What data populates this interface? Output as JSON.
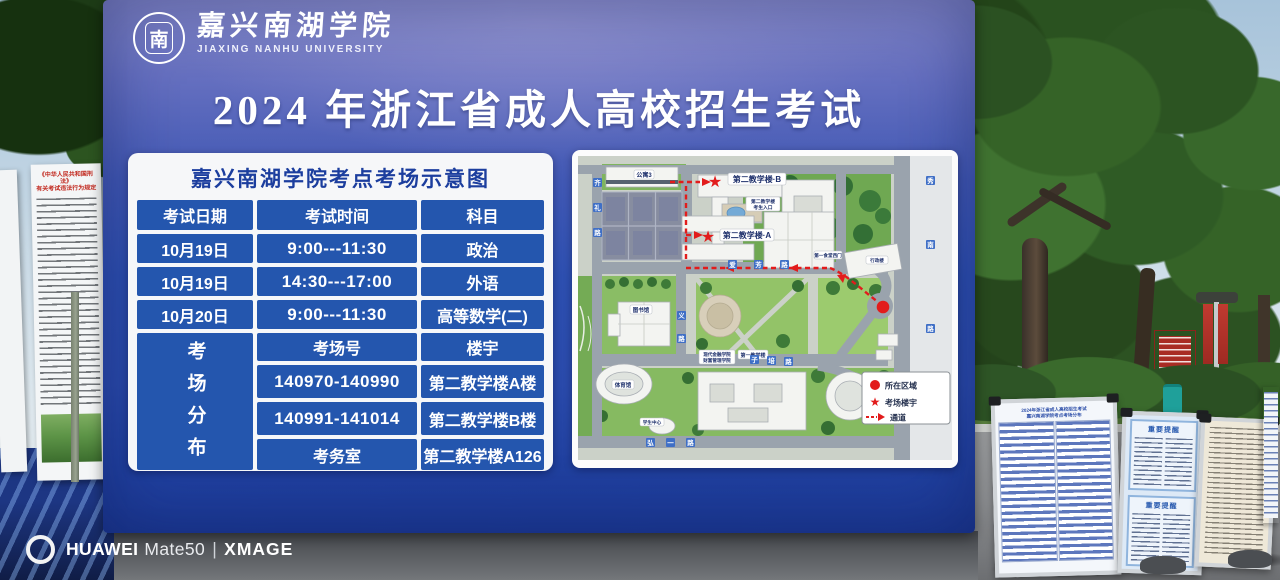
{
  "colors": {
    "billboard_blue": "#2d4fb0",
    "billboard_purple_top": "#8387c9",
    "table_cell_blue": "#2456ae",
    "accent_red": "#dd1f1f",
    "road_tile_blue": "#3f6fc6"
  },
  "billboard": {
    "university": {
      "seal_char": "南",
      "name_cn": "嘉兴南湖学院",
      "name_en": "JIAXING NANHU UNIVERSITY"
    },
    "title": "2024 年浙江省成人高校招生考试",
    "schedule": {
      "panel_title": "嘉兴南湖学院考点考场示意图",
      "headers": [
        "考试日期",
        "考试时间",
        "科目"
      ],
      "rows": [
        [
          "10月19日",
          "9:00---11:30",
          "政治"
        ],
        [
          "10月19日",
          "14:30---17:00",
          "外语"
        ],
        [
          "10月20日",
          "9:00---11:30",
          "高等数学(二)"
        ]
      ],
      "distribution_label": "考场分布",
      "venue_headers": [
        "考场号",
        "楼宇"
      ],
      "venue_rows": [
        [
          "140970-140990",
          "第二教学楼A楼"
        ],
        [
          "140991-141014",
          "第二教学楼B楼"
        ],
        [
          "考务室",
          "第二教学楼A126"
        ]
      ]
    },
    "map": {
      "buildings": {
        "apartment3": "公寓3",
        "teaching_b": "第二教学楼·B",
        "teaching_a": "第二教学楼·A",
        "entrance_line1": "第二教学楼",
        "entrance_line2": "考生入口",
        "canteen_west_gate": "第一食堂西门",
        "finance_line1": "现代金融学院",
        "finance_line2": "财富管理学院",
        "first_teaching": "第一教学楼",
        "library": "图书馆",
        "gym": "体育馆",
        "student_center": "学生中心",
        "admin": "行政楼"
      },
      "roads": {
        "qili": "齐礼路",
        "aifang": "爱芳路",
        "yilu": "义路",
        "zipei": "子培路",
        "hongyi": "弘一路",
        "xiunan": "秀南路"
      },
      "legend": [
        {
          "icon": "location-dot",
          "label": "所在区域"
        },
        {
          "icon": "exam-star",
          "label": "考场楼宇"
        },
        {
          "icon": "route-arrow",
          "label": "通道"
        }
      ]
    }
  },
  "left_posters": {
    "law_title_1": "《中华人民共和国刑法》",
    "law_title_2": "有关考试违法行为规定"
  },
  "right_posters": {
    "seat_title_1": "2024年浙江省成人高校招生考试",
    "seat_title_2": "嘉兴南湖学院考点考场分布",
    "notice_header": "重要提醒"
  },
  "watermark": {
    "brand": "HUAWEI",
    "model": "Mate50",
    "separator": "|",
    "tech": "XMAGE"
  }
}
